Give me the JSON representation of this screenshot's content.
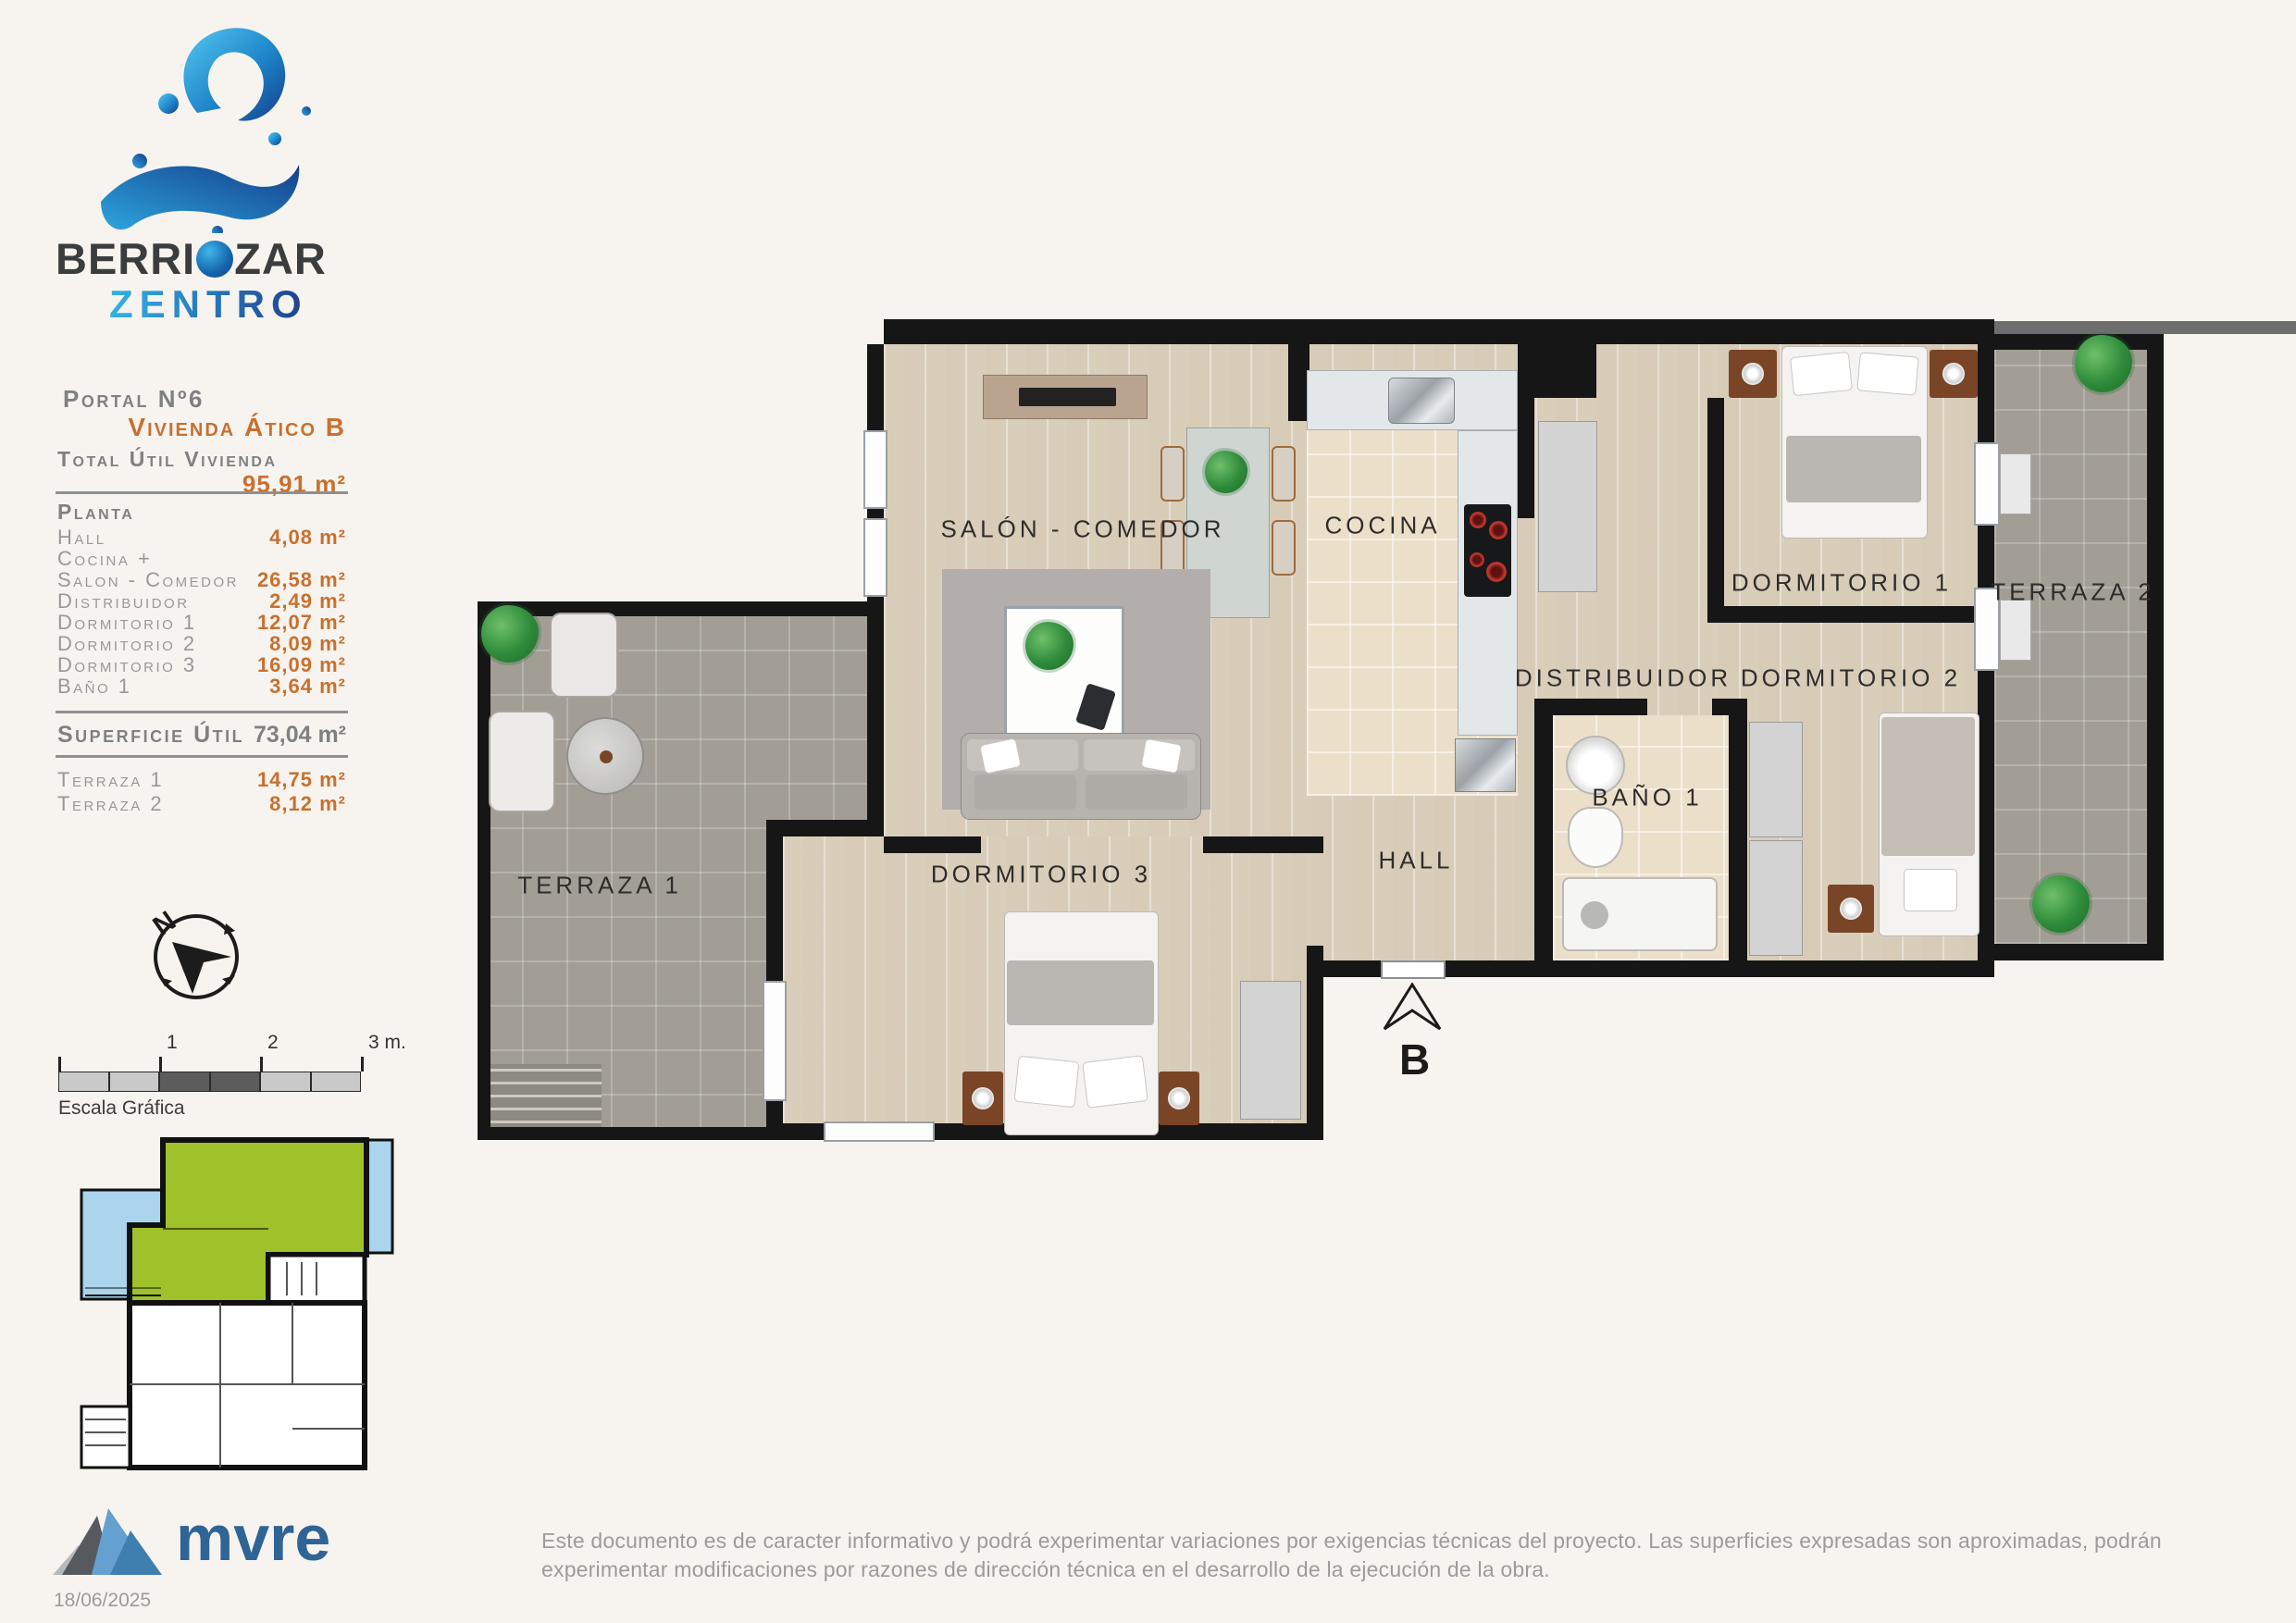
{
  "brand": {
    "name_part1": "BERRI",
    "name_part2": "ZAR",
    "name_line2": "ZENTRO",
    "splash_icon": "water-splash-logo",
    "color_dark": "#3b3c3e",
    "color_blue_light": "#33b2e6",
    "color_blue_dark": "#1c3f8f"
  },
  "sidebar": {
    "portal": "Portal Nº6",
    "unit_name": "Vivienda Ático B",
    "total_label": "Total Útil Vivienda",
    "total_value": "95,91 m²",
    "planta_title": "Planta",
    "planta_rows": [
      {
        "label": "Hall",
        "value": "4,08 m²"
      },
      {
        "label": "Cocina +",
        "value": ""
      },
      {
        "label": "Salon - Comedor",
        "value": "26,58 m²"
      },
      {
        "label": "Distribuidor",
        "value": "2,49 m²"
      },
      {
        "label": "Dormitorio 1",
        "value": "12,07 m²"
      },
      {
        "label": "Dormitorio 2",
        "value": "8,09 m²"
      },
      {
        "label": "Dormitorio 3",
        "value": "16,09 m²"
      },
      {
        "label": "Baño 1",
        "value": "3,64 m²"
      }
    ],
    "superficie_label": "Superficie Útil",
    "superficie_value": "73,04 m²",
    "terraza_rows": [
      {
        "label": "Terraza 1",
        "value": "14,75 m²"
      },
      {
        "label": "Terraza 2",
        "value": "8,12 m²"
      }
    ],
    "accent_color": "#c9702e"
  },
  "compass": {
    "north_label": "N"
  },
  "scale_bar": {
    "caption": "Escala Gráfica",
    "ticks": [
      "1",
      "2",
      "3 m."
    ]
  },
  "minimap": {
    "highlight_color": "#9fc12a",
    "terrace_color": "#aad5ec",
    "description": "building-key-plan-with-highlighted-unit"
  },
  "plan": {
    "rooms": [
      {
        "label": "SALÓN - COMEDOR"
      },
      {
        "label": "COCINA"
      },
      {
        "label": "DISTRIBUIDOR"
      },
      {
        "label": "DORMITORIO 1"
      },
      {
        "label": "DORMITORIO 2"
      },
      {
        "label": "DORMITORIO 3"
      },
      {
        "label": "HALL"
      },
      {
        "label": "BAÑO 1"
      },
      {
        "label": "TERRAZA 1"
      },
      {
        "label": "TERRAZA 2"
      }
    ],
    "entrance_label": "B"
  },
  "footer": {
    "logo_text": "mvre",
    "logo_icon": "mountain-logo",
    "logo_color": "#2f6496",
    "date": "18/06/2025",
    "disclaimer": "Este documento es de caracter informativo y podrá experimentar variaciones por exigencias técnicas del proyecto. Las superficies expresadas son aproximadas, podrán experimentar modificaciones por razones de dirección técnica en el desarrollo de la ejecución de la obra."
  }
}
